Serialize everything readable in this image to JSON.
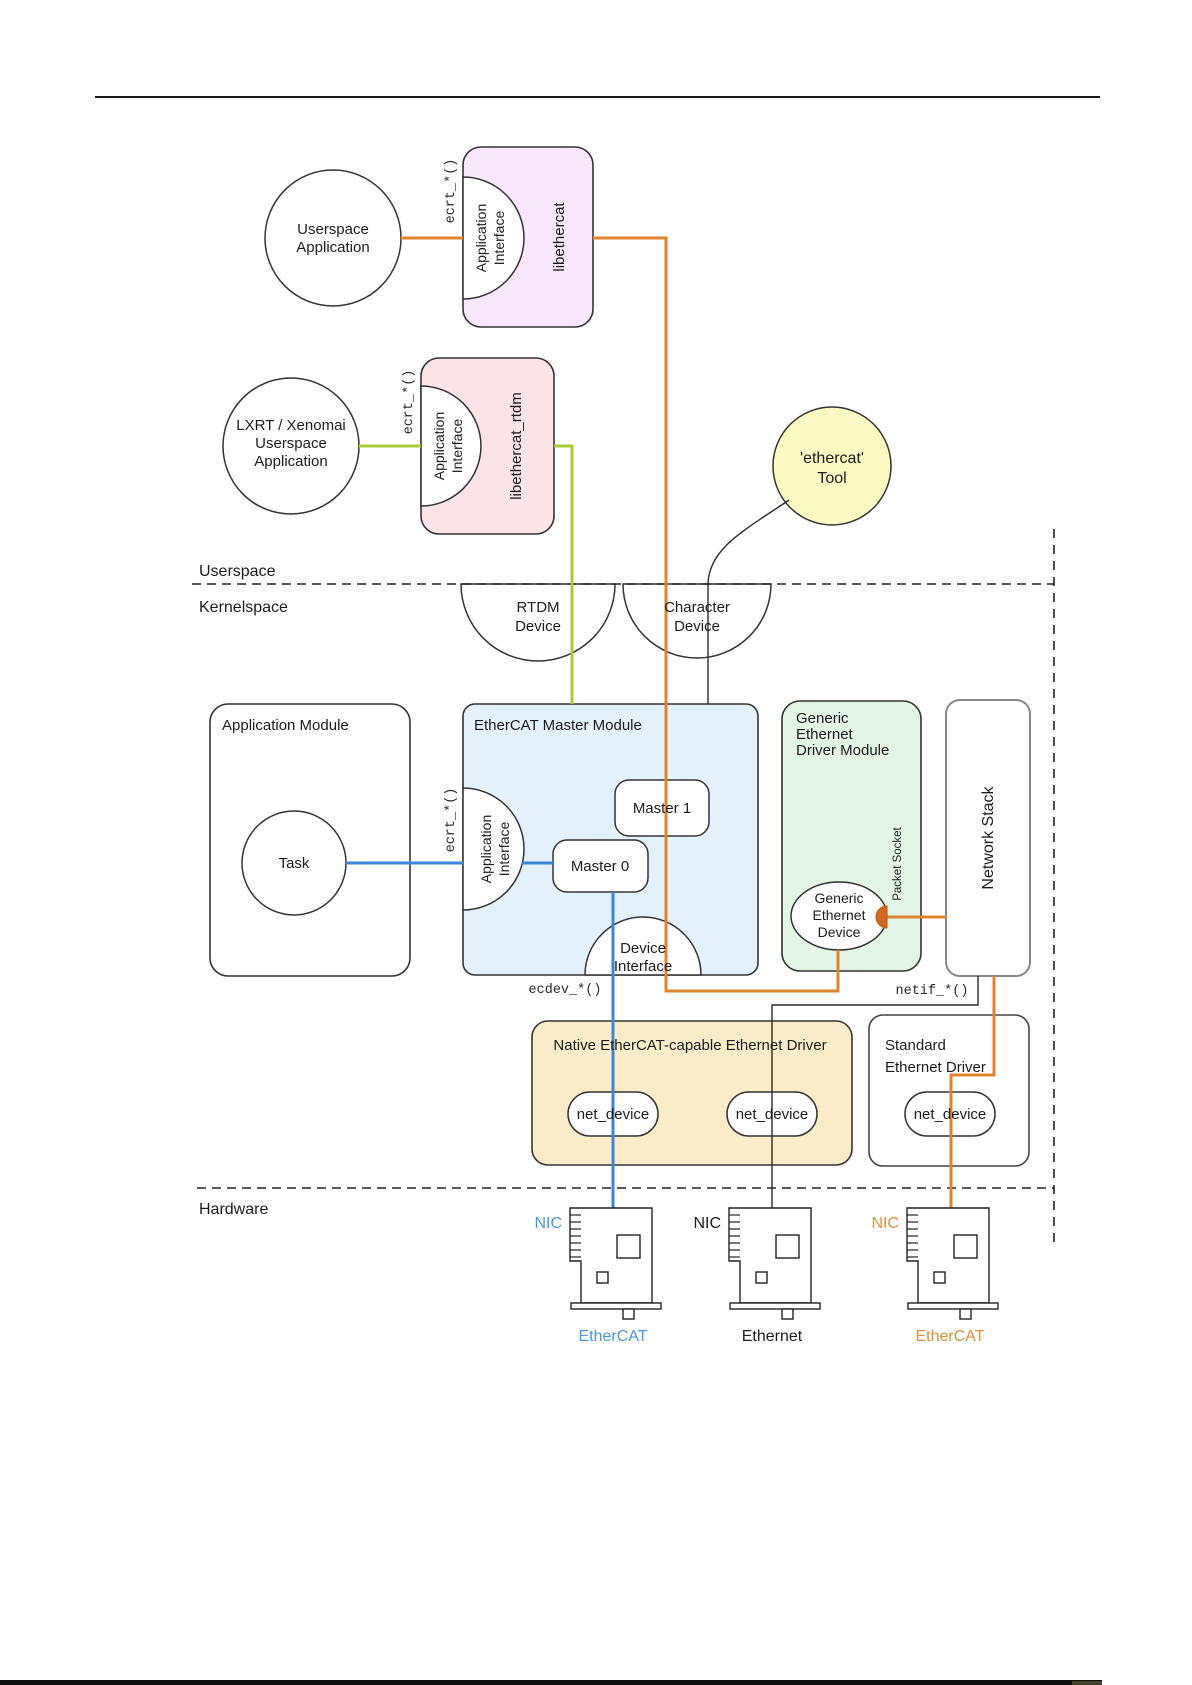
{
  "colors": {
    "orange_line": "#E0832F",
    "blue_line": "#3987D8",
    "green_line": "#A8CC38",
    "black_line": "#2b2b2b",
    "libethercat_fill": "#F8E6FA",
    "libethercat_rtdm_fill": "#FBE3E8",
    "ethercat_tool_fill": "#FAFAC3",
    "master_module_fill": "#E4F1FA",
    "generic_module_fill": "#E3F6E5",
    "native_driver_fill": "#FAECC8",
    "nic_blue_text": "#4B96DB",
    "nic_orange_text": "#DC9140"
  },
  "boundaries": {
    "userspace_label": "Userspace",
    "kernelspace_label": "Kernelspace",
    "hardware_label": "Hardware"
  },
  "code_labels": {
    "ecrt": "ecrt_*()",
    "ecdev": "ecdev_*()",
    "netif": "netif_*()"
  },
  "interface": {
    "line1": "Application",
    "line2": "Interface"
  },
  "userspace": {
    "userspace_app": {
      "line1": "Userspace",
      "line2": "Application"
    },
    "libethercat": "libethercat",
    "lxrt_app": {
      "line1": "LXRT / Xenomai",
      "line2": "Userspace",
      "line3": "Application"
    },
    "libethercat_rtdm": "libethercat_rtdm",
    "ethercat_tool": {
      "line1": "'ethercat'",
      "line2": "Tool"
    }
  },
  "kernelspace": {
    "rtdm_device": {
      "line1": "RTDM",
      "line2": "Device"
    },
    "char_device": {
      "line1": "Character",
      "line2": "Device"
    },
    "app_module": {
      "title": "Application Module",
      "task": "Task"
    },
    "master_module": {
      "title": "EtherCAT Master Module",
      "master1": "Master 1",
      "master0": "Master 0",
      "device_interface": {
        "line1": "Device",
        "line2": "Interface"
      }
    },
    "generic_module": {
      "title_line1": "Generic",
      "title_line2": "Ethernet",
      "title_line3": "Driver Module",
      "device": {
        "line1": "Generic",
        "line2": "Ethernet",
        "line3": "Device"
      },
      "packet_socket": "Packet Socket"
    },
    "network_stack": "Network Stack",
    "native_driver": {
      "title": "Native EtherCAT-capable Ethernet Driver"
    },
    "standard_driver": {
      "title_line1": "Standard",
      "title_line2": "Ethernet Driver"
    },
    "net_device": "net_device"
  },
  "hardware": {
    "nic_label": "NIC",
    "bus1": "EtherCAT",
    "bus2": "Ethernet",
    "bus3": "EtherCAT"
  }
}
